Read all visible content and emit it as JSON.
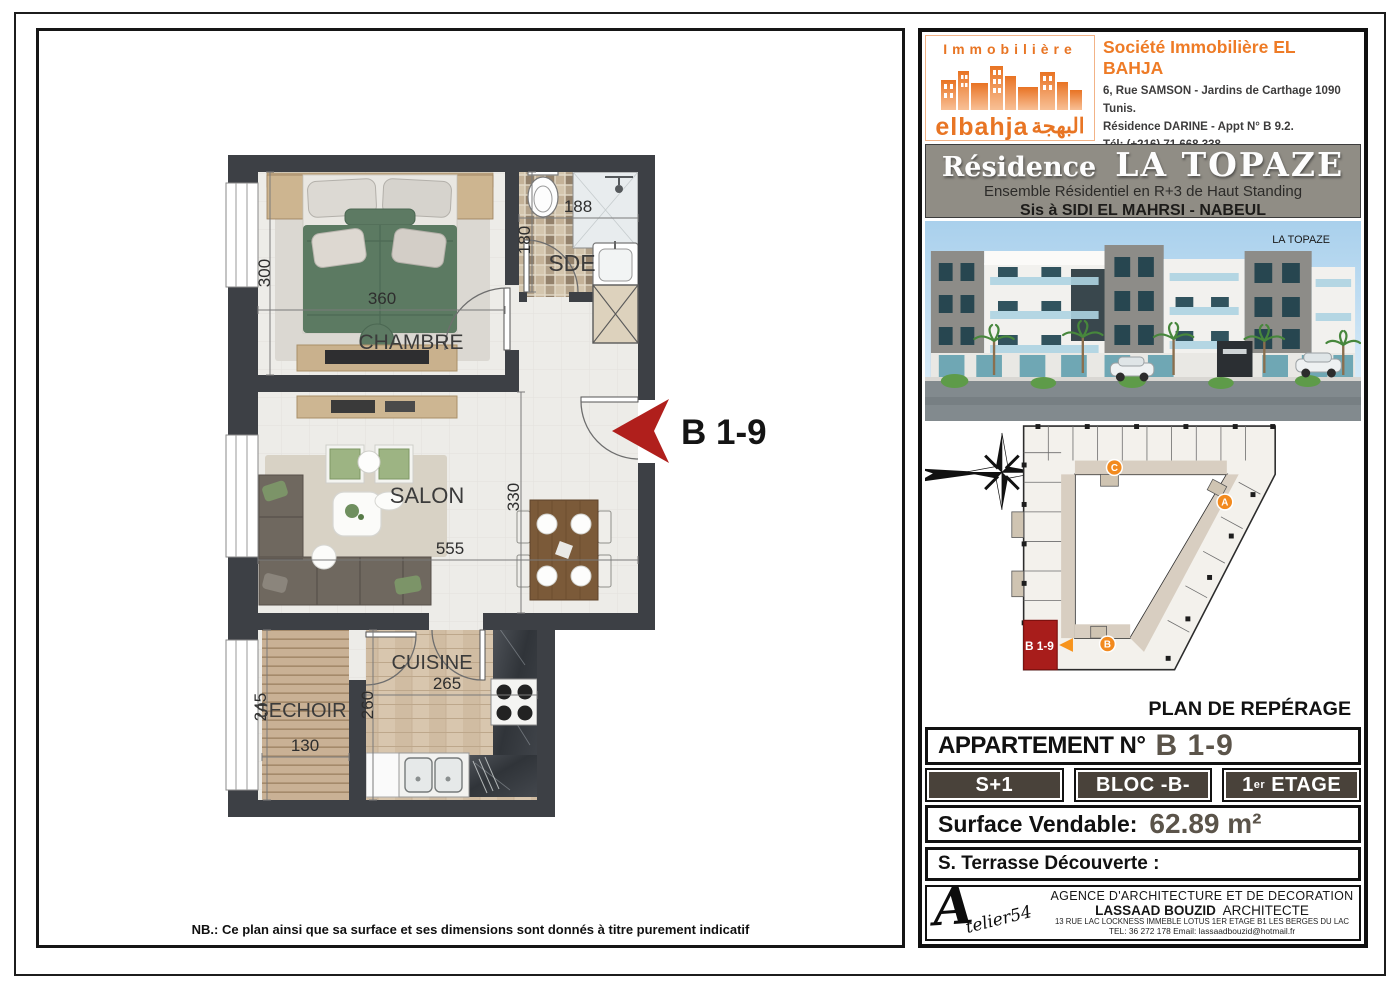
{
  "page": {
    "note": "NB.: Ce plan ainsi que sa surface et ses dimensions sont donnés à titre purement indicatif"
  },
  "floor_plan": {
    "arrow_label": "B 1-9",
    "rooms": {
      "chambre": {
        "name": "CHAMBRE",
        "w": "360",
        "h": "300"
      },
      "sde": {
        "name": "SDE",
        "w": "188",
        "h": "180"
      },
      "salon": {
        "name": "SALON",
        "w": "555",
        "h": "330"
      },
      "cuisine": {
        "name": "CUISINE",
        "w": "265",
        "h": "260"
      },
      "sechoir": {
        "name": "SECHOIR",
        "w": "130",
        "h": "245"
      }
    }
  },
  "company": {
    "logo_line1": "Immobilière",
    "logo_name": "elbahja",
    "logo_arabic": "البهجة",
    "name": "Société Immobilière EL BAHJA",
    "address1": "6, Rue SAMSON - Jardins de Carthage 1090 Tunis.",
    "address2": "Résidence DARINE - Appt N° B 9.2.",
    "tel": "Tél: (+216) 71 668 338",
    "gsm": "Gsm: (+216)  29 726 248 - (+216) 90 740 602",
    "email": "Email: commercial@elbahja.tn - Siteweb: www.elbahja.tn"
  },
  "residence": {
    "title_prefix": "Résidence",
    "title_name": "LA TOPAZE",
    "subtitle": "Ensemble Résidentiel en R+3 de Haut Standing",
    "location": "Sis à SIDI EL MAHRSI - NABEUL",
    "photo_sign": "LA TOPAZE"
  },
  "site_plan": {
    "title": "PLAN DE REPÉRAGE",
    "north": "N",
    "block_a": "A",
    "block_b": "B",
    "block_c": "C",
    "highlight_unit": "B 1-9"
  },
  "apartment": {
    "label": "APPARTEMENT N°",
    "number": "B 1-9",
    "type": "S+1",
    "bloc": "BLOC -B-",
    "floor_num": "1",
    "floor_sup": "er",
    "floor_word": " ETAGE",
    "surface_label": "Surface Vendable:",
    "surface_value": "62.89 m²",
    "terrace_label": "S. Terrasse Découverte :"
  },
  "architect": {
    "logo_a": "A",
    "logo_rest": "telier54",
    "line1": "AGENCE D'ARCHITECTURE ET DE DECORATION",
    "name": "LASSAAD BOUZID",
    "title": "  ARCHITECTE",
    "address": "13 RUE LAC LOCKNESS IMMEBLE LOTUS 1ER ETAGE B1 LES BERGES DU LAC",
    "contact": "TEL: 36 272 178   Email: lassaadbouzid@hotmail.fr"
  },
  "colors": {
    "orange": "#e87524",
    "banner_gray": "#908d85",
    "badge_brown": "#49423a",
    "value_gray": "#5b544a",
    "arrow_red": "#b01f1c",
    "wall": "#3d4045"
  }
}
